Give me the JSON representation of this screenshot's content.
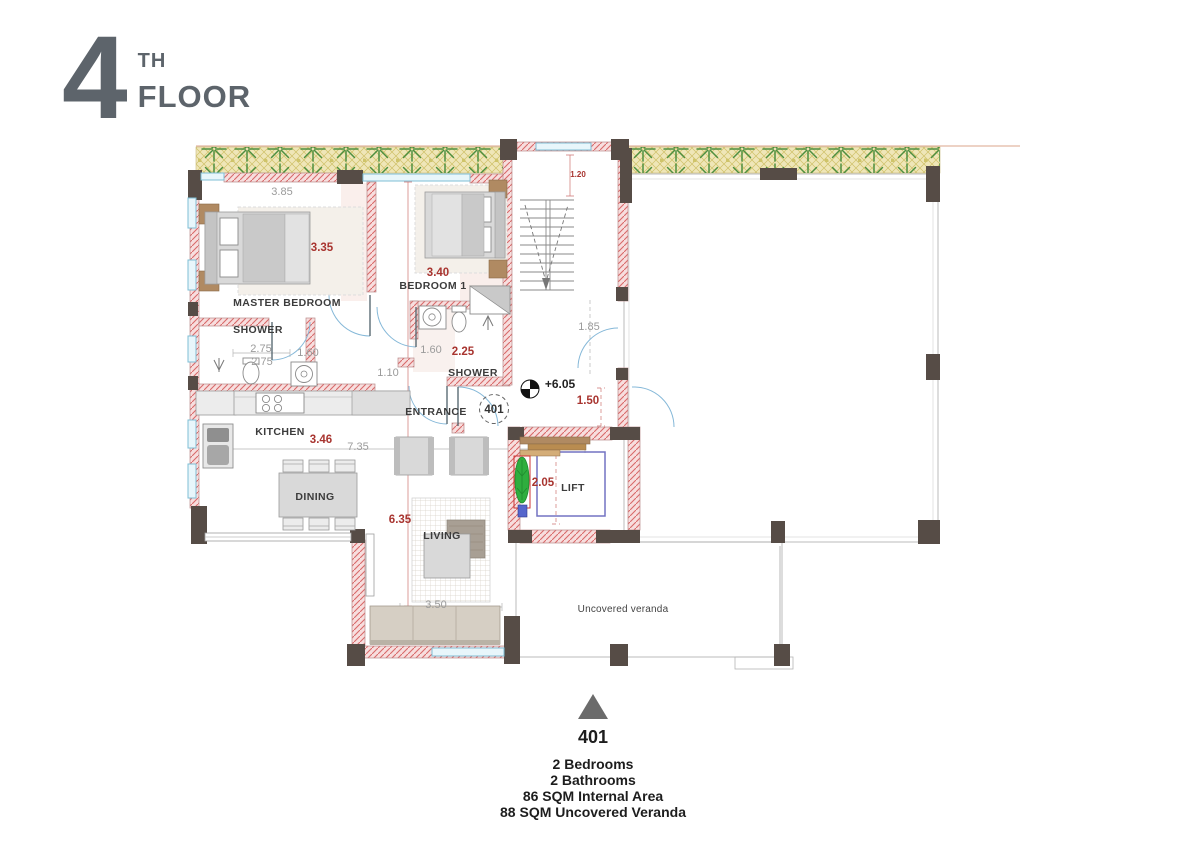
{
  "title": {
    "number": "4",
    "suffix": "TH",
    "word": "FLOOR"
  },
  "summary": {
    "unit": "401",
    "lines": [
      "2 Bedrooms",
      "2 Bathrooms",
      "86 SQM Internal Area",
      "88 SQM Uncovered Veranda"
    ]
  },
  "plan": {
    "labels": {
      "master_bedroom": "MASTER BEDROOM",
      "bedroom_1": "BEDROOM 1",
      "shower_1": "SHOWER",
      "shower_2": "SHOWER",
      "kitchen": "KITCHEN",
      "dining": "DINING",
      "living": "LIVING",
      "entrance": "ENTRANCE",
      "lift": "LIFT",
      "veranda": "Uncovered veranda"
    },
    "markers": {
      "level": "+6.05",
      "unit_circle": "401"
    },
    "dims": {
      "master_width": "3.85",
      "master_height": "3.35",
      "bedroom1_width": "3.40",
      "shower1_width": "2.75",
      "shower1_depth": "2.75",
      "shower1_door": "1.60",
      "shower2_left": "1.60",
      "shower2_width": "2.25",
      "hall_width": "1.10",
      "stair_width": "1.20",
      "lobby_depth": "1.85",
      "entry_width": "1.50",
      "kitchen_width": "3.46",
      "internal_width": "7.35",
      "living_length": "6.35",
      "lift_width": "2.05",
      "sofa_width": "3.50"
    },
    "colors": {
      "title_gray": "#5d646b",
      "wall_fill": "#f7dede",
      "wall_hatch_line": "#d86a6a",
      "column": "#564c46",
      "dim_red": "#a8342f",
      "dim_gray": "#9b9b9b",
      "label_dark": "#3c3c3c",
      "window_blue": "#7fbfd6",
      "plant_green": "#4e8f3f",
      "plant_band": "#efe6b8",
      "tile_line": "#c3c3c3",
      "lift_outline": "#7272c2",
      "bench_wood": "#caa06a",
      "pot_plant_green": "#2fae3e"
    }
  }
}
